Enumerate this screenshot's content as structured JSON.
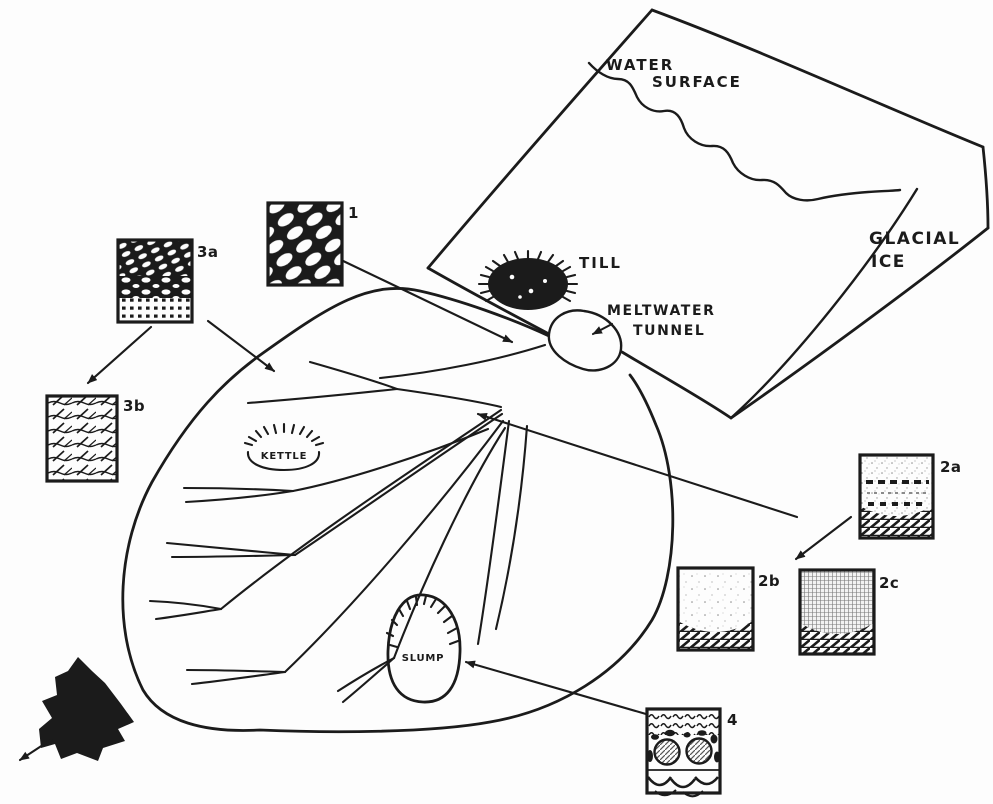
{
  "diagram": {
    "labels": {
      "water_surface_1": "WATER",
      "water_surface_2": "SURFACE",
      "glacial_ice_1": "GLACIAL",
      "glacial_ice_2": "ICE",
      "till": "TILL",
      "meltwater_tunnel_1": "MELTWATER",
      "meltwater_tunnel_2": "TUNNEL",
      "kettle": "KETTLE",
      "slump": "SLUMP"
    },
    "samples": {
      "s1": "1",
      "s2a": "2a",
      "s2b": "2b",
      "s2c": "2c",
      "s3a": "3a",
      "s3b": "3b",
      "s4": "4"
    }
  },
  "colors": {
    "ink": "#1b1b1b",
    "paper": "#fdfdfd"
  }
}
